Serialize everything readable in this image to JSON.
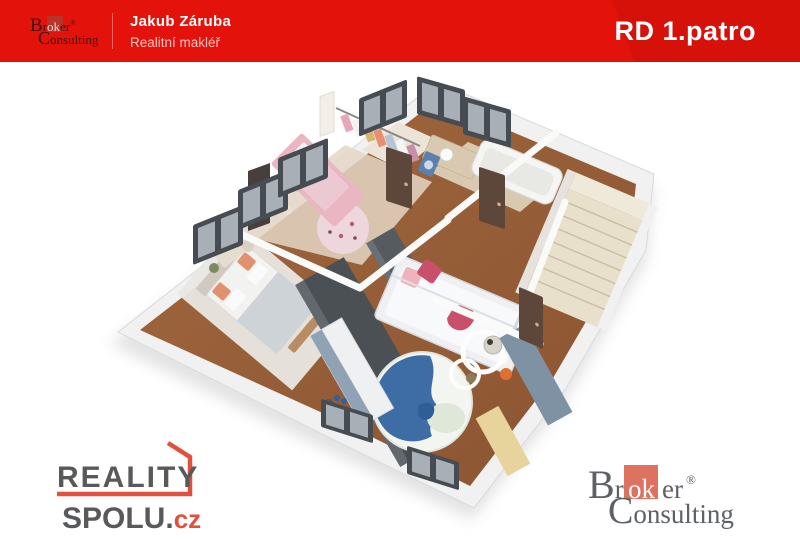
{
  "banner": {
    "agent_name": "Jakub Záruba",
    "agent_role": "Realitní makléř",
    "title": "RD 1.patro"
  },
  "broker_logo": {
    "cap_b": "B",
    "r_after_b": "r",
    "ok": "ok",
    "er": "er",
    "reg": "®",
    "cap_c": "C",
    "onsulting": "onsulting"
  },
  "reality_logo": {
    "line1": "REALITY",
    "line2": "SPOLU.",
    "tld": "cz"
  },
  "palette": {
    "banner_red": "#e3120b",
    "text_pink": "#f6c3c1",
    "logo_gray": "#58595b",
    "logo_red": "#e2503c",
    "bc_gray": "#5d6166",
    "bc_salmon": "#dd7261",
    "banner_logo_dark": "#3f1410",
    "banner_logo_sq": "#b8342a",
    "wall": "#f0f1f0",
    "wall_edge": "#d9dbda",
    "wood": "#a2683e",
    "wood_dark": "#8a5431",
    "floor_pale": "#e4d6c6",
    "tile_bath": "#d9c9b0",
    "closet_floor": "#ece4d8",
    "stair": "#e9e0cc",
    "stair_line": "#c9bda2",
    "marble": "#e9e7e3",
    "window_frame": "#474c52",
    "window_glass": "#a8afb7",
    "door": "#5d473a",
    "dark_wardrobe": "#4b5054",
    "dark_wardrobe_hi": "#62686e",
    "slate_cabinet": "#7e92a4",
    "yellow_cabinet": "#e6d49c",
    "bed_white": "#f2f2f0",
    "blanket_gray": "#ced3d7",
    "headboard": "#cfc9bf",
    "salmon_pillow": "#e2916f",
    "pink_bed": "#eab6c2",
    "pink_blanket": "#ecc8d2",
    "rug_pink": "#edd6dc",
    "rug_blue": "#3e6da6",
    "rug_cream": "#dfe7d8",
    "kidsbed_frame": "#eef0f2",
    "pillow_red": "#c9506b",
    "pillow_pink": "#efb3bd",
    "desk_top": "#8fa3b5",
    "shadow": "#cccccc"
  }
}
